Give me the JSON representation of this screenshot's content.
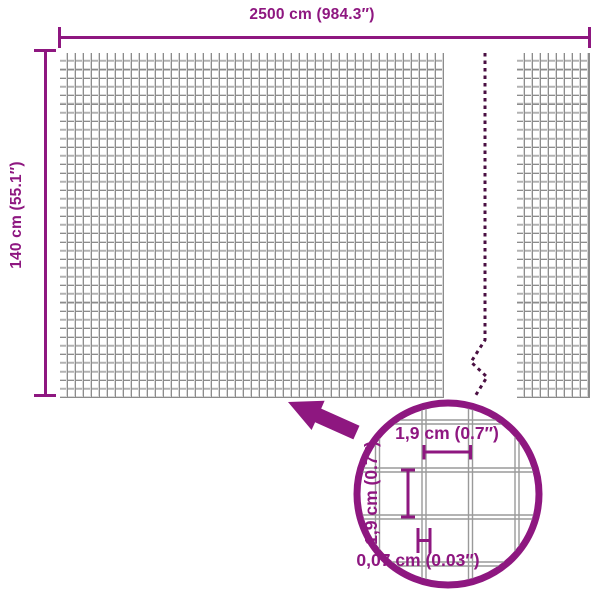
{
  "colors": {
    "accent": "#8E1780",
    "break_dash": "#4A0F42",
    "mesh_line_dark": "#8C8C8C",
    "mesh_line_light": "#D8D8D8",
    "detail_wire": "#9A9A9A",
    "background": "#FFFFFF"
  },
  "diagram": {
    "width_dimension_label": "2500 cm (984.3″)",
    "height_dimension_label": "140 cm (55.1″)",
    "detail": {
      "mesh_width_label": "1,9 cm (0.7″)",
      "mesh_height_label": "1,9 cm (0.7″)",
      "wire_thickness_label": "0,07 cm (0.03″)"
    },
    "icons": {
      "arrow": "zoom-callout-arrow-icon",
      "magnifier": "magnifier-circle-icon",
      "break": "panel-break-dashed-line"
    }
  }
}
